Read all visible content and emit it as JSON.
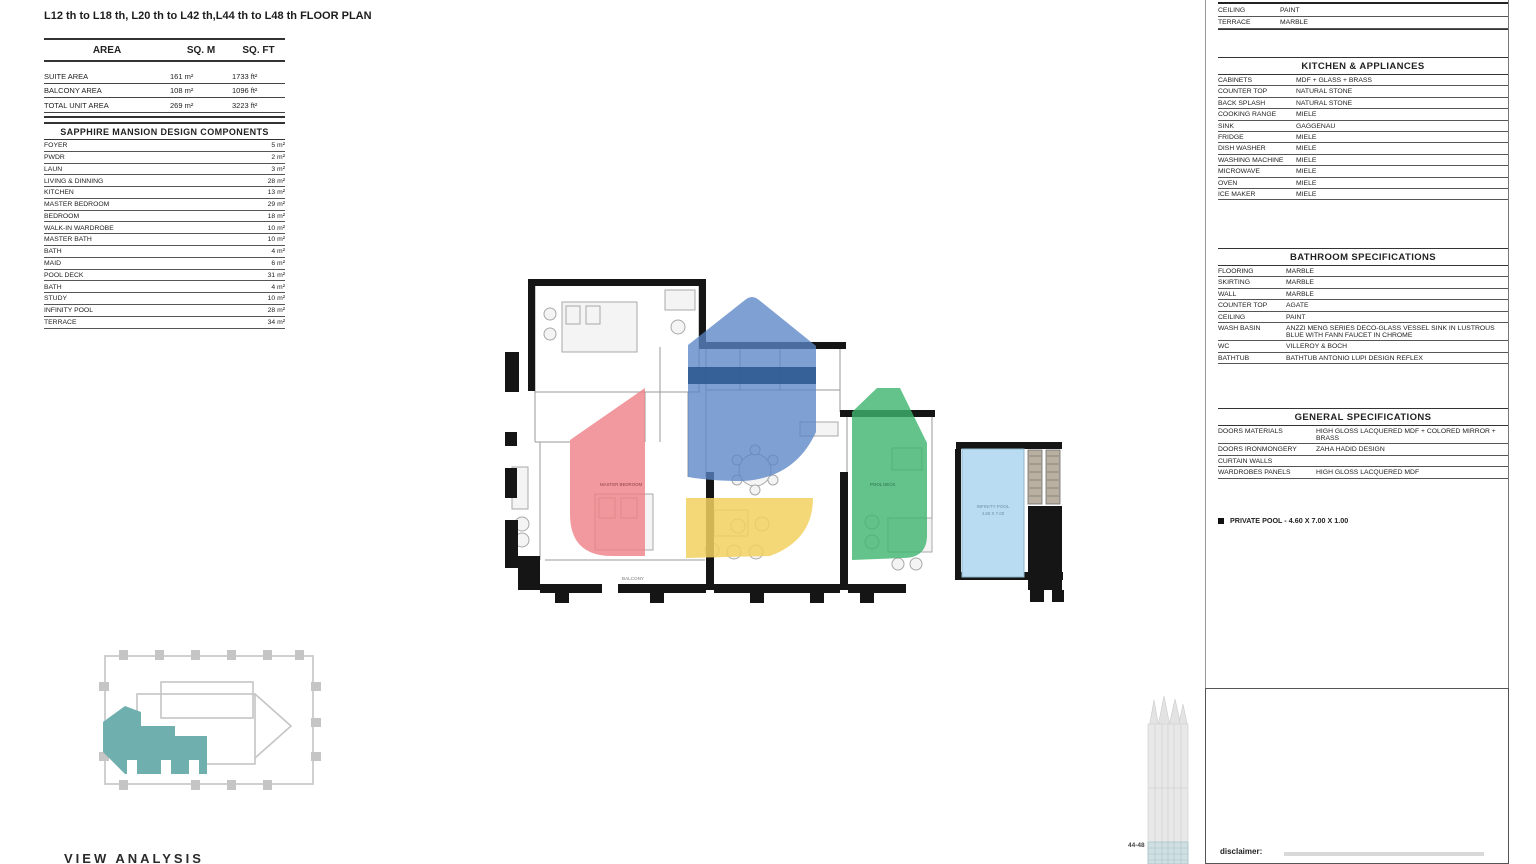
{
  "page": {
    "title": "L12 th to L18 th, L20 th to L42 th,L44 th to L48 th FLOOR PLAN",
    "view_analysis": "VIEW ANALYSIS",
    "disclaimer_label": "disclaimer:"
  },
  "area": {
    "header_rows": [
      [
        "AREA",
        "SQ. M",
        "SQ. FT"
      ]
    ],
    "rows": [
      [
        "SUITE AREA",
        "161 m²",
        "1733 ft²"
      ],
      [
        "BALCONY AREA",
        "108 m²",
        "1096 ft²"
      ],
      [
        "TOTAL UNIT AREA",
        "269 m²",
        "3223 ft²"
      ]
    ]
  },
  "components": {
    "title": "SAPPHIRE MANSION DESIGN COMPONENTS",
    "rows": [
      [
        "FOYER",
        "5 m²"
      ],
      [
        "PWDR",
        "2 m²"
      ],
      [
        "LAUN",
        "3 m²"
      ],
      [
        "LIVING & DINNING",
        "28 m²"
      ],
      [
        "KITCHEN",
        "13 m²"
      ],
      [
        "MASTER BEDROOM",
        "29 m²"
      ],
      [
        "BEDROOM",
        "18 m²"
      ],
      [
        "WALK-IN WARDROBE",
        "10 m²"
      ],
      [
        "MASTER BATH",
        "10 m²"
      ],
      [
        "BATH",
        "4 m²"
      ],
      [
        "MAID",
        "6 m²"
      ],
      [
        "POOL DECK",
        "31 m²"
      ],
      [
        "BATH",
        "4 m²"
      ],
      [
        "STUDY",
        "10 m²"
      ],
      [
        "INFINITY POOL",
        "28 m²"
      ],
      [
        "TERRACE",
        "34 m²"
      ]
    ]
  },
  "finishes_partial": {
    "rows": [
      [
        "CEILING",
        "PAINT"
      ],
      [
        "TERRACE",
        "MARBLE"
      ]
    ]
  },
  "kitchen": {
    "title": "KITCHEN & APPLIANCES",
    "rows": [
      [
        "CABINETS",
        "MDF + GLASS + BRASS"
      ],
      [
        "COUNTER TOP",
        "NATURAL STONE"
      ],
      [
        "BACK SPLASH",
        "NATURAL STONE"
      ],
      [
        "COOKING RANGE",
        "MIELE"
      ],
      [
        "SINK",
        "GAGGENAU"
      ],
      [
        "FRIDGE",
        "MIELE"
      ],
      [
        "DISH WASHER",
        "MIELE"
      ],
      [
        "WASHING MACHINE",
        "MIELE"
      ],
      [
        "MICROWAVE",
        "MIELE"
      ],
      [
        "OVEN",
        "MIELE"
      ],
      [
        "ICE MAKER",
        "MIELE"
      ]
    ]
  },
  "bathroom": {
    "title": "BATHROOM SPECIFICATIONS",
    "rows": [
      [
        "FLOORING",
        "MARBLE"
      ],
      [
        "SKIRTING",
        "MARBLE"
      ],
      [
        "WALL",
        "MARBLE"
      ],
      [
        "COUNTER TOP",
        "AGATE"
      ],
      [
        "CEILING",
        "PAINT"
      ],
      [
        "WASH BASIN",
        "ANZZI  MENG SERIES DECO-GLASS VESSEL SINK IN LUSTROUS BLUE WITH FANN FAUCET IN CHROME"
      ],
      [
        "WC",
        "VILLEROY & BOCH"
      ],
      [
        "BATHTUB",
        "BATHTUB ANTONIO LUPI DESIGN REFLEX"
      ]
    ]
  },
  "general": {
    "title": "GENERAL SPECIFICATIONS",
    "rows": [
      [
        "DOORS MATERIALS",
        "HIGH GLOSS LACQUERED MDF + COLORED MIRROR + BRASS"
      ],
      [
        "DOORS IRONMONGERY",
        "ZAHA HADID DESIGN"
      ],
      [
        "CURTAIN WALLS",
        ""
      ],
      [
        "WARDROBES PANELS",
        "HIGH GLOSS LACQUERED MDF"
      ]
    ]
  },
  "pool_note": {
    "text": "PRIVATE POOL  -  4.60 X 7.00 X 1.00"
  },
  "tower": {
    "floors_label": "44-48"
  },
  "plan_labels": {
    "balcony": "BALCONY",
    "pool_deck": "POOL DECK",
    "master_bedroom": "MASTER BEDROOM",
    "infinity_pool": "INFINITY POOL",
    "pool_dims": "4.60 X 7.00"
  },
  "colors": {
    "overlay_blue": "#5b85c6",
    "overlay_blue_dark": "#2d5a91",
    "overlay_red": "#ee7f86",
    "overlay_green": "#3cb46d",
    "overlay_yellow": "#f2d160",
    "pool_blue": "#badcf2",
    "keyplan_teal": "#6fafae"
  }
}
